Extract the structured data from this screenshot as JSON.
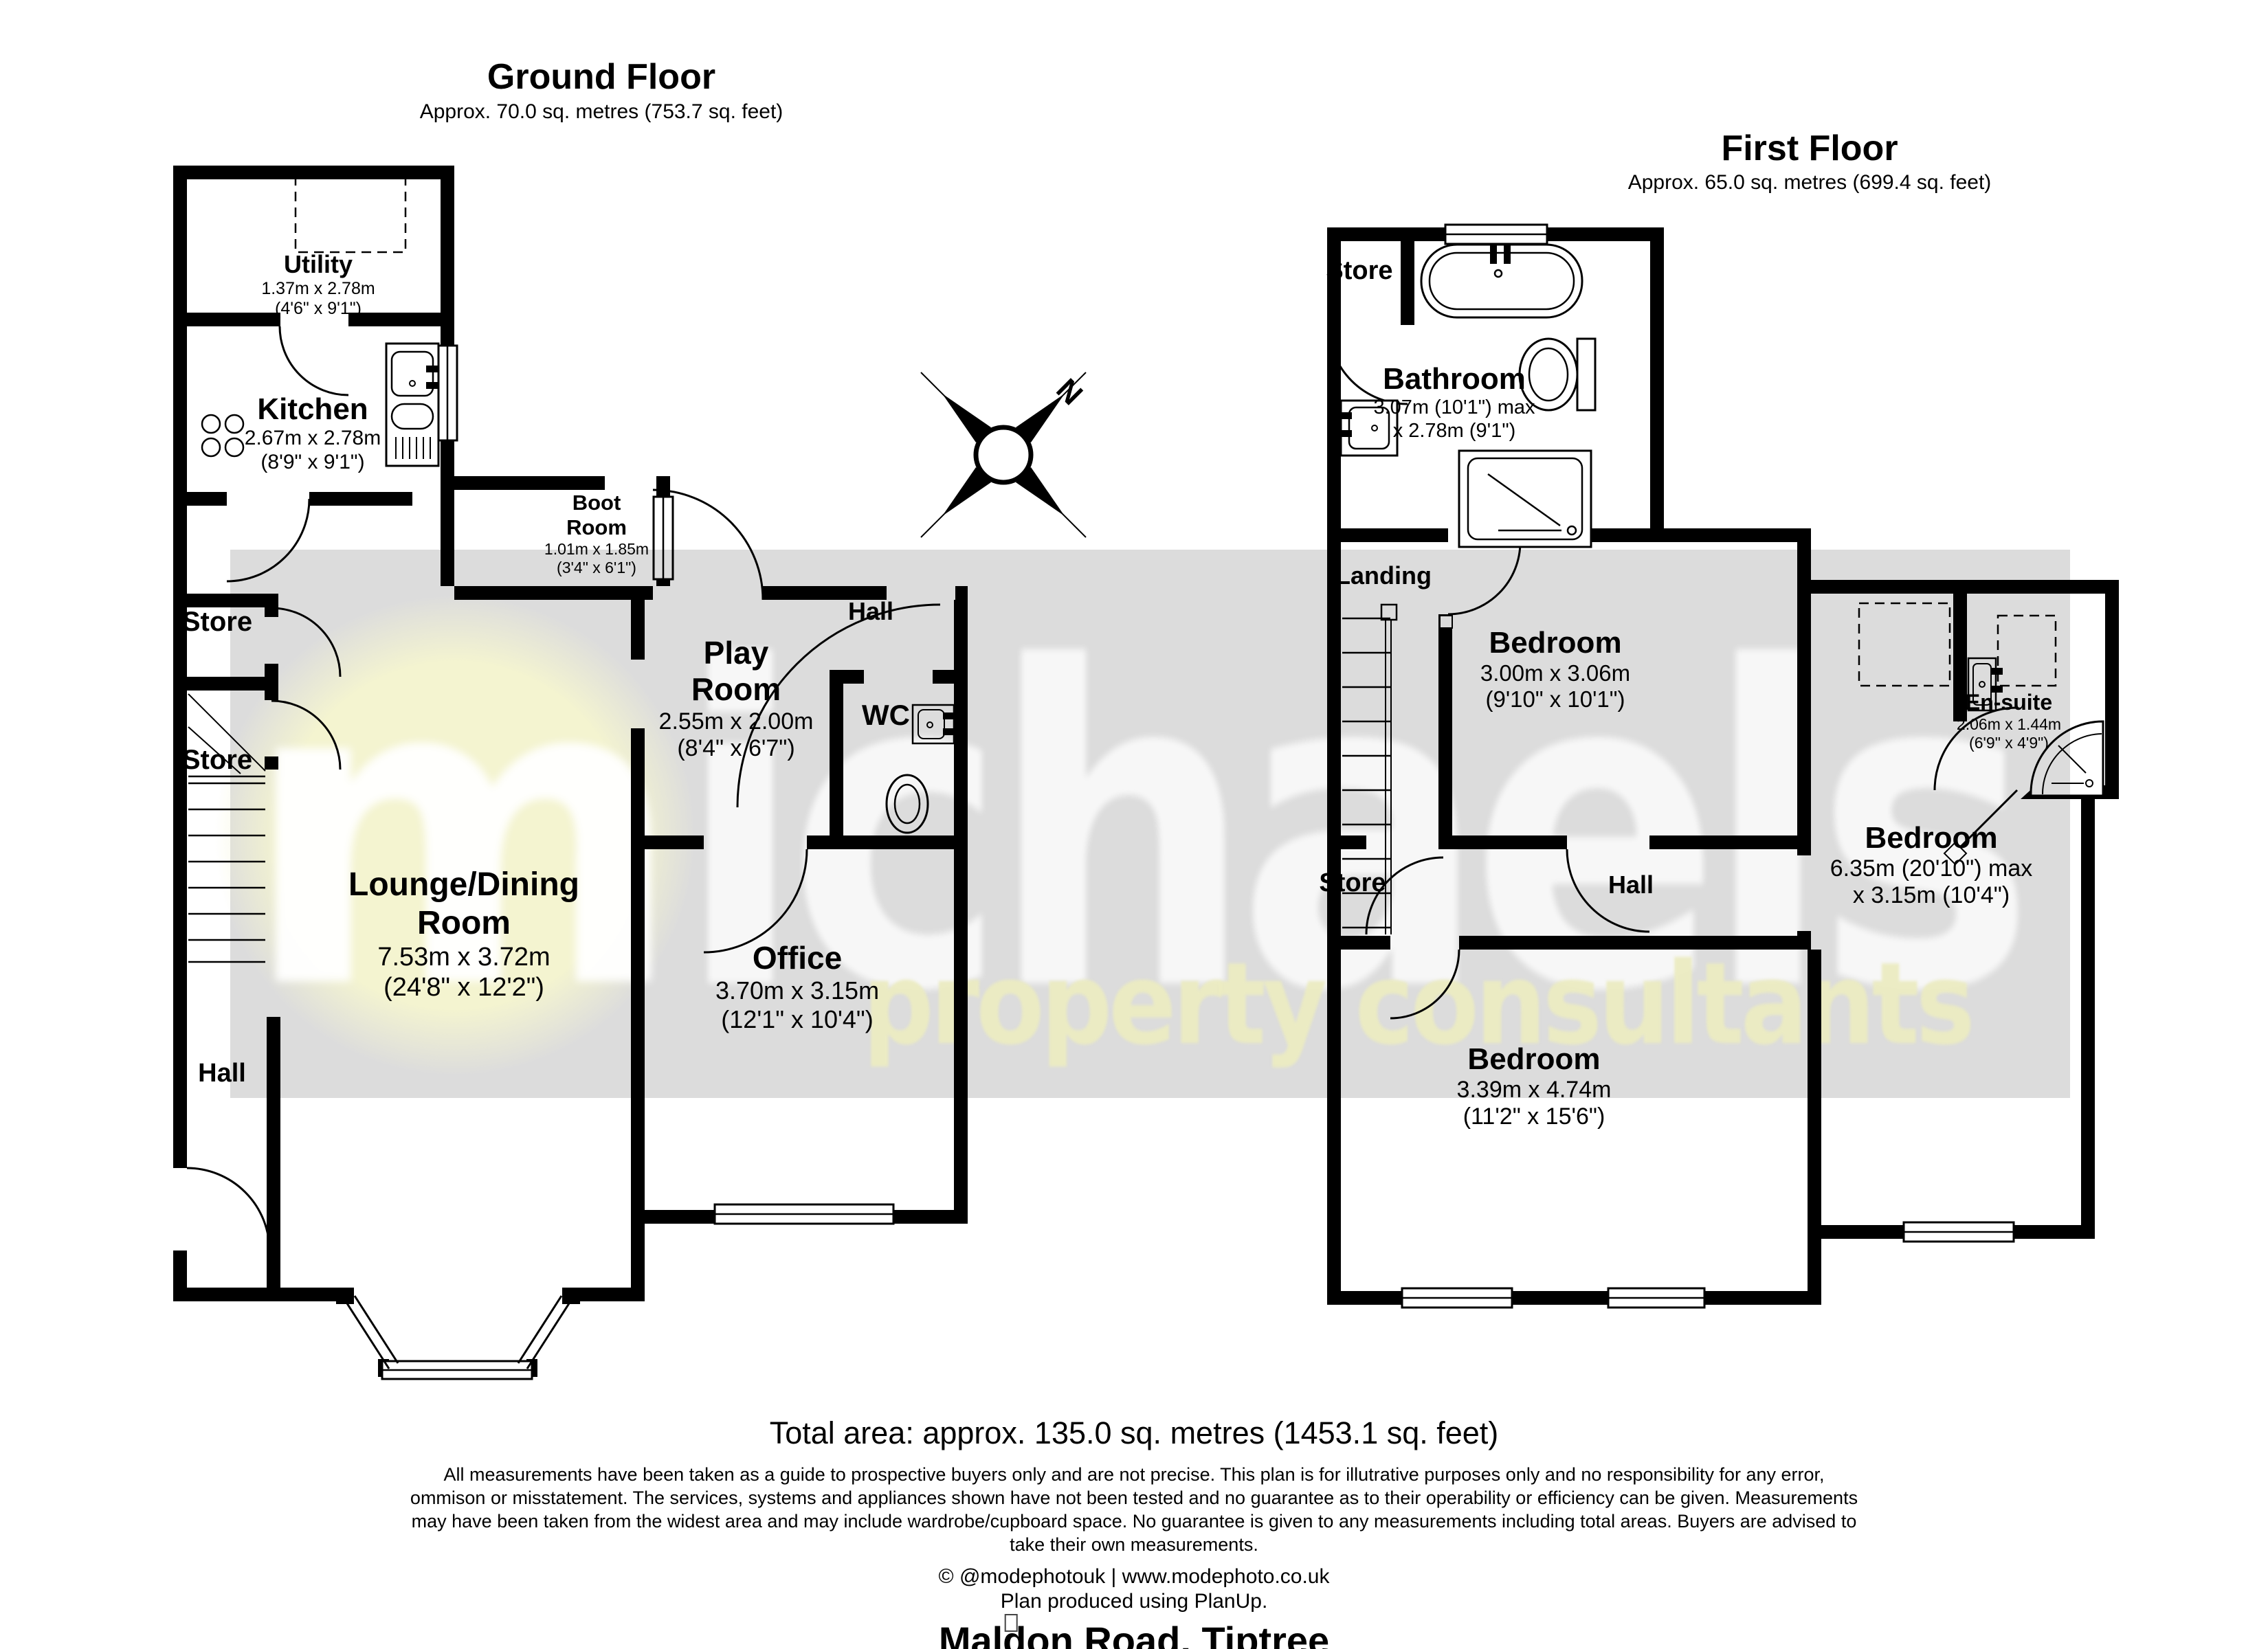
{
  "ground_floor": {
    "title": "Ground Floor",
    "subtitle": "Approx. 70.0 sq. metres (753.7 sq. feet)",
    "utility": {
      "name": "Utility",
      "dims_m": "1.37m x 2.78m",
      "dims_ft": "(4'6\" x 9'1\")"
    },
    "kitchen": {
      "name": "Kitchen",
      "dims_m": "2.67m x 2.78m",
      "dims_ft": "(8'9\" x 9'1\")"
    },
    "boot_room": {
      "name_line1": "Boot",
      "name_line2": "Room",
      "dims_m": "1.01m x 1.85m",
      "dims_ft": "(3'4\" x 6'1\")"
    },
    "play_room": {
      "name_line1": "Play",
      "name_line2": "Room",
      "dims_m": "2.55m x 2.00m",
      "dims_ft": "(8'4\" x 6'7\")"
    },
    "hall_top": {
      "name": "Hall"
    },
    "wc": {
      "name": "WC"
    },
    "store_1": {
      "name": "Store"
    },
    "store_2": {
      "name": "Store"
    },
    "lounge_dining": {
      "name_line1": "Lounge/Dining",
      "name_line2": "Room",
      "dims_m": "7.53m x 3.72m",
      "dims_ft": "(24'8\" x 12'2\")"
    },
    "office": {
      "name": "Office",
      "dims_m": "3.70m x 3.15m",
      "dims_ft": "(12'1\" x 10'4\")"
    },
    "hall_bottom": {
      "name": "Hall"
    }
  },
  "first_floor": {
    "title": "First Floor",
    "subtitle": "Approx. 65.0 sq. metres (699.4 sq. feet)",
    "store_top": {
      "name": "Store"
    },
    "bathroom": {
      "name": "Bathroom",
      "dims_line1": "3.07m (10'1\") max",
      "dims_line2": "x 2.78m (9'1\")"
    },
    "landing": {
      "name": "Landing"
    },
    "bedroom_1": {
      "name": "Bedroom",
      "dims_m": "3.00m x 3.06m",
      "dims_ft": "(9'10\" x 10'1\")"
    },
    "en_suite": {
      "name": "En-suite",
      "dims_m": "2.06m x 1.44m",
      "dims_ft": "(6'9\" x 4'9\")"
    },
    "bedroom_2": {
      "name": "Bedroom",
      "dims_line1": "6.35m (20'10\") max",
      "dims_line2": "x 3.15m (10'4\")"
    },
    "store_mid": {
      "name": "Store"
    },
    "hall": {
      "name": "Hall"
    },
    "bedroom_3": {
      "name": "Bedroom",
      "dims_m": "3.39m x 4.74m",
      "dims_ft": "(11'2\" x 15'6\")"
    }
  },
  "compass": {
    "north": "N"
  },
  "watermark": {
    "monogram": "m",
    "brand": "ichaels",
    "tagline": "property consultants"
  },
  "summary": {
    "total_area": "Total area: approx. 135.0 sq. metres (1453.1 sq. feet)"
  },
  "disclaimer": {
    "line1": "All measurements have been taken as a guide to prospective buyers only and are not precise. This plan is for illutrative purposes only and no responsibility for any error,",
    "line2": "ommison or misstatement. The services, systems and appliances shown have not been tested and no guarantee as to their operability or efficiency can be given. Measurements",
    "line3": "may have been taken from the widest area and may include wardrobe/cupboard space. No guarantee is given to any measurements including total areas. Buyers are advised to",
    "line4": "take their own measurements."
  },
  "credits": {
    "copyright": "© @modephotouk | www.modephoto.co.uk",
    "produced": "Plan produced using PlanUp.",
    "address": "Maldon Road, Tiptree"
  },
  "colors": {
    "wall": "#000000",
    "band": "#dcdcdc",
    "disc": "#f4f4d0",
    "tagline": "#ebebc2"
  }
}
